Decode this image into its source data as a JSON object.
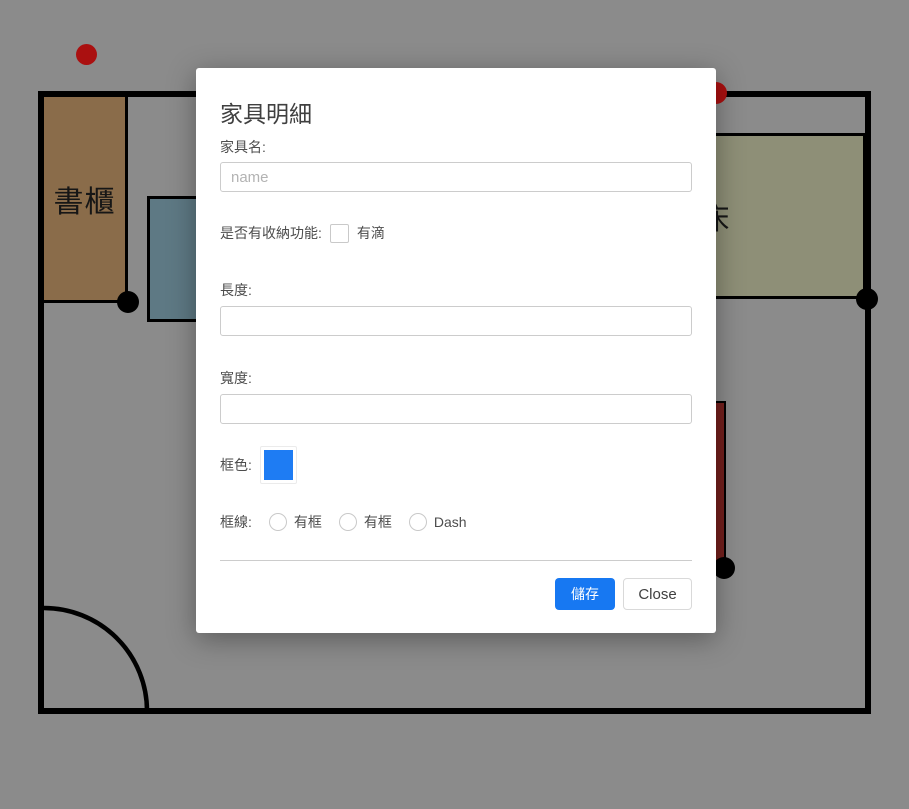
{
  "canvas": {
    "furniture": {
      "bookshelf": {
        "label": "書櫃",
        "fill": "#8a6c4a"
      },
      "table": {
        "fill": "#5e7984"
      },
      "bed": {
        "label": "床",
        "fill": "#8e8f77"
      },
      "bar": {
        "fill": "#74201d"
      }
    },
    "handles": {
      "red": "#aa1010",
      "black": "#000000"
    },
    "wall_color": "#000000",
    "backdrop_color": "#8b8b8b"
  },
  "modal": {
    "title": "家具明細",
    "fields": {
      "name": {
        "label": "家具名:",
        "placeholder": "name",
        "value": ""
      },
      "storage": {
        "label": "是否有收納功能:",
        "checkbox_label": "有滴",
        "checked": false
      },
      "length": {
        "label": "長度:",
        "value": ""
      },
      "width": {
        "label": "寬度:",
        "value": ""
      },
      "frame_color": {
        "label": "框色:",
        "color": "#1e7cf3"
      },
      "frame_line": {
        "label": "框線:",
        "options": [
          {
            "label": "有框",
            "checked": false
          },
          {
            "label": "有框",
            "checked": false
          },
          {
            "label": "Dash",
            "checked": false
          }
        ]
      }
    },
    "buttons": {
      "save": "儲存",
      "close": "Close"
    },
    "accent_color": "#1778f2"
  }
}
